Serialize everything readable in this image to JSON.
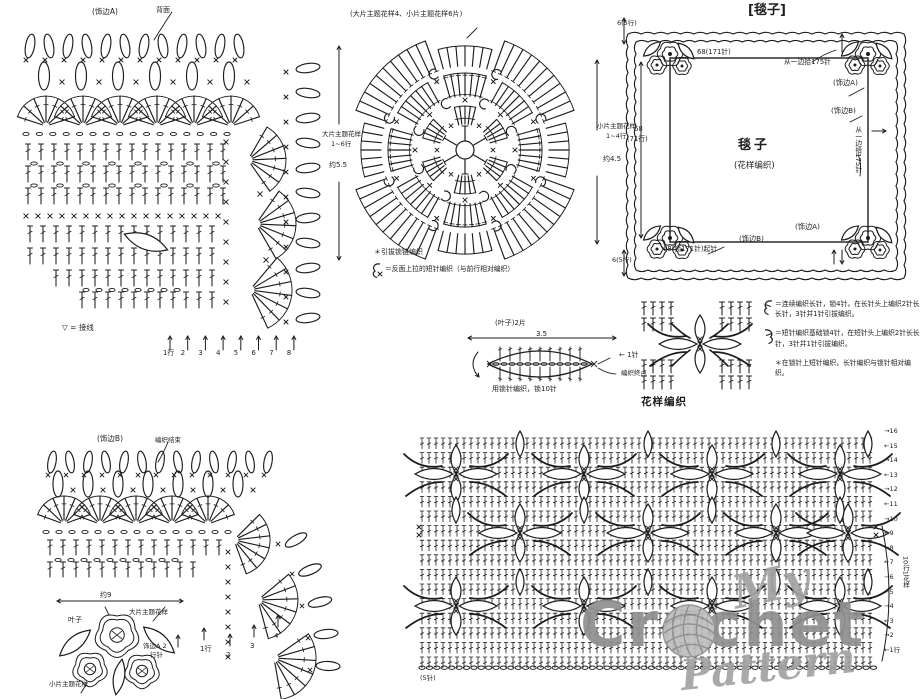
{
  "colors": {
    "ink": "#1c1c1c",
    "watermark": "#8f8f8f",
    "bg": "#ffffff"
  },
  "edging_a": {
    "title": "(饰边A)",
    "back_label": "背面",
    "thread_legend": "▽ = 接线",
    "row_numbers": [
      "1行",
      "2",
      "3",
      "4",
      "5",
      "6",
      "7",
      "8"
    ]
  },
  "motif": {
    "title": "(大片主题花样4、小片主题花样6片)",
    "left_label_1": "大片主题花样",
    "left_label_2": "1~6行",
    "left_size": "约5.5",
    "right_label_1": "小片主题花样",
    "right_label_2": "1~4行",
    "right_size": "约4.5",
    "note_star": "＊引拔锁链编织",
    "note_symbol": "＝反面上拉的短针编织（与前行相对编织）"
  },
  "blanket": {
    "title": "[毯子]",
    "corner_top": "6(5行)",
    "top_count": "68(171针)",
    "pickup_top": "从一边拾175针",
    "edge_a": "(饰边A)",
    "edge_b": "(饰边B)",
    "pickup_right": "从一边拾175针",
    "left_count_1": "68",
    "left_count_2": "(71行)",
    "center_label": "毯子",
    "center_sub": "(花样编织)",
    "corner_bottom": "6(5行)",
    "cast_on": "68(锁171针)起针",
    "edge_b_bottom": "(饰边B)",
    "edge_a_bottom": "(饰边A)"
  },
  "leaf": {
    "title": "(叶子)2片",
    "width": "3.5",
    "tip_label": "← 1针",
    "end_label": "编织终点",
    "note": "用锁针编织，锁10针"
  },
  "pattern_repeat": {
    "label": "花样编织"
  },
  "legend": {
    "items": [
      {
        "symbol": "cluster-a-icon",
        "text": "＝连续编织长针，锁4针，在长针头上编织2针长长针，3针并1针引拔编织。"
      },
      {
        "symbol": "cluster-b-icon",
        "text": "＝短针编织基础锁4针，在短针头上编织2针长长针，3针并1针引拔编织。"
      },
      {
        "symbol": "",
        "text": "＊在锁针上短针编织，长针编织与锁针相对编织。"
      }
    ]
  },
  "edging_b": {
    "title": "(饰边B)",
    "end_label": "编织结束",
    "pickup_label_1": "饰边A 2",
    "pickup_label_2": "行针",
    "row_numbers": [
      "1行",
      "2",
      "3",
      "4"
    ]
  },
  "flower_cluster": {
    "width_label": "约9",
    "leaf_label": "叶子",
    "large_flower": "大片主题花样",
    "small_flower": "小片主题花样"
  },
  "pattern_chart": {
    "rows": [
      "→16",
      "←15",
      "→14",
      "←13",
      "→12",
      "←11",
      "→10",
      "←9",
      "→8",
      "←7",
      "→6",
      "←5",
      "→4",
      "←3",
      "→2",
      "←1行"
    ],
    "repeat_label": "10行1花样",
    "base_label": "(5针)"
  },
  "watermark": {
    "line1": "My",
    "line2": "Crochet",
    "line3": "Pattern"
  }
}
